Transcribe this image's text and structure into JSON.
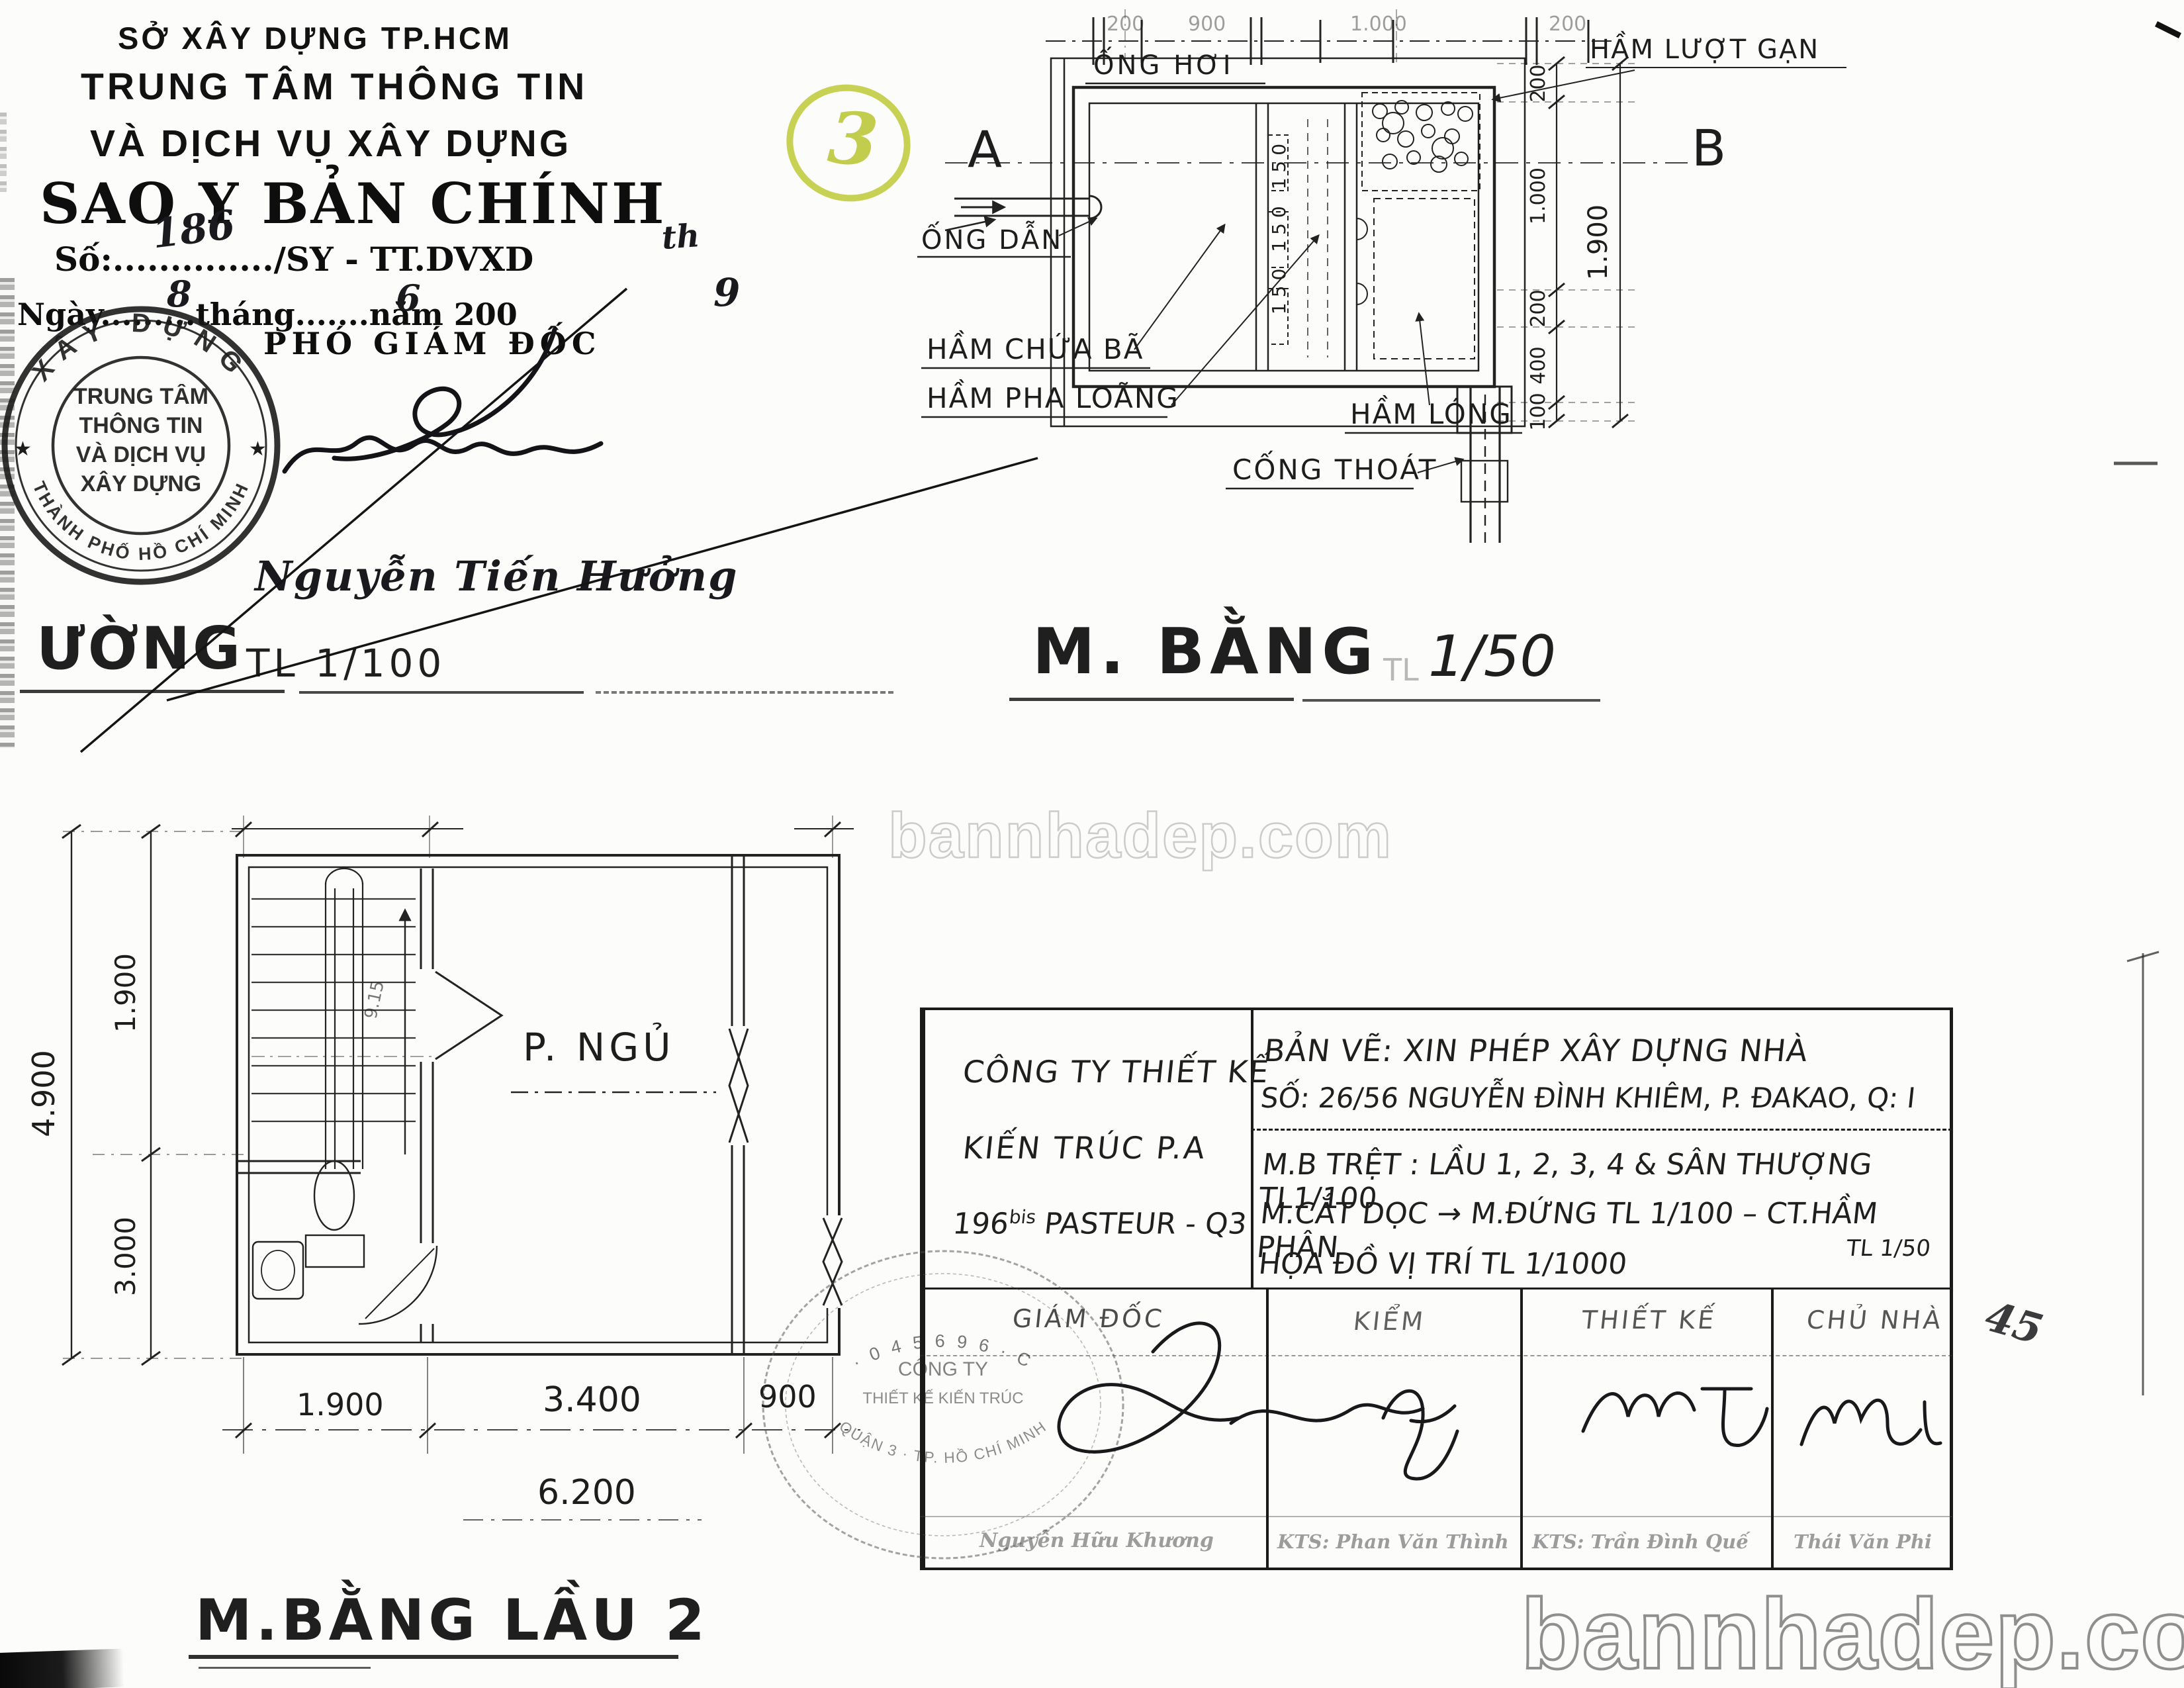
{
  "page": {
    "watermark": "bannhadep.com",
    "margin_note": "45"
  },
  "certification": {
    "agency_line1": "SỞ XÂY DỰNG TP.HCM",
    "agency_line2": "TRUNG TÂM THÔNG TIN",
    "agency_line3": "VÀ DỊCH VỤ XÂY DỰNG",
    "copy_title": "SAO Y BẢN CHÍNH",
    "number_label": "Số:",
    "number_dots": "..............",
    "number_value": "186",
    "number_suffix": "/SY - TT.DVXD",
    "number_hand": "th",
    "date_label": "Ngày",
    "date_dots1": ".........",
    "date_day": "8",
    "date_word_month": "tháng",
    "date_dots2": ".......",
    "date_month": "6",
    "date_word_year": "năm 200",
    "date_year": "9",
    "page_mark": "3",
    "deputy_title": "PHÓ GIÁM ĐỐC",
    "signer_name": "Nguyễn Tiến Hưởng",
    "stamp": {
      "arc_top": "XÂY DỰNG",
      "arc_bottom": "THÀNH PHỐ HỒ CHÍ MINH",
      "star": "★",
      "line1": "TRUNG TÂM",
      "line2": "THÔNG TIN",
      "line3": "VÀ DỊCH VỤ",
      "line4": "XÂY DỰNG"
    }
  },
  "left_drawing": {
    "title": "ƯỜNG",
    "scale": "TL 1/100"
  },
  "septic_plan": {
    "title": "M. BẰNG",
    "scale_prefix": "TL",
    "scale": "1/50",
    "label_ong_hoi": "ỐNG HƠI",
    "label_ong_dan": "ỐNG DẪN",
    "label_ham_chua_ba": "HẦM CHỨA BÃ",
    "label_ham_pha_loang": "HẦM PHA LOÃNG",
    "label_ham_long": "HẦM LÓNG",
    "label_ham_luot_gan": "HẦM LƯỢT GẠN",
    "label_cong_thoat": "CỐNG THOÁT",
    "section_a": "A",
    "section_b": "B",
    "top_dims": [
      "200",
      "900",
      "1.000",
      "200"
    ],
    "inner_dims": "150 150 150",
    "right_dims": [
      "200",
      "1.000",
      "200",
      "400",
      "100"
    ],
    "right_total": "1.900"
  },
  "floor_plan": {
    "title": "M.BẰNG LẦU 2",
    "room_label": "P. NGỦ",
    "stair_note": "9.15",
    "dim_bottom_1": "1.900",
    "dim_bottom_2": "3.400",
    "dim_bottom_3": "900",
    "dim_bottom_total": "6.200",
    "dim_left_total": "4.900",
    "dim_left_1": "1.900",
    "dim_left_2": "3.000"
  },
  "title_block": {
    "company_line1": "CÔNG TY THIẾT KẾ",
    "company_line2": "KIẾN TRÚC P.A",
    "company_addr_num": "196",
    "company_addr_sup": "bis",
    "company_addr_rest": " PASTEUR - Q3",
    "drawing_title": "BẢN VẼ: XIN PHÉP XÂY DỰNG NHÀ",
    "site_address": "SỐ: 26/56 NGUYỄN ĐÌNH KHIÊM, P. ĐAKAO, Q: I",
    "content_line1": "M.B TRỆT : LẦU 1, 2, 3, 4 & SÂN THƯỢNG TL1/100",
    "content_line2": "M.CẮT DỌC → M.ĐỨNG TL 1/100 – CT.HẦM PHÂN",
    "content_line2_scale": "TL 1/50",
    "content_line3": "HỌA ĐỒ VỊ TRÍ TL 1/1000",
    "col1": "GIÁM ĐỐC",
    "col2": "KIỂM",
    "col3": "THIẾT KẾ",
    "col4": "CHỦ NHÀ",
    "name1": "Nguyễn Hữu Khương",
    "name2": "KTS: Phan Văn Thình",
    "name3": "KTS: Trần Đình Quế",
    "name4": "Thái Văn Phi",
    "round_stamp_arc": "· 0 4 5 6 9 6 · C",
    "round_stamp_bottom": "QUẬN 3 · TP. HỒ CHÍ MINH",
    "round_stamp_line1": "CÔNG TY",
    "round_stamp_line2": "THIẾT KẾ KIẾN TRÚC"
  }
}
